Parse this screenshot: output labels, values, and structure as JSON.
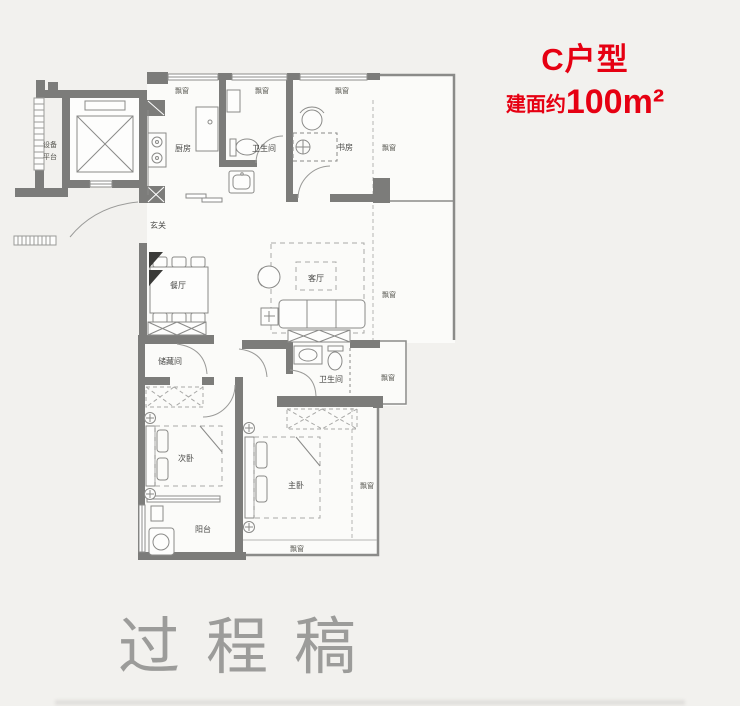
{
  "title": {
    "unit": "C户型",
    "area_prefix": "建面约",
    "area_value": "100m²"
  },
  "watermark": "过程稿",
  "rooms": {
    "equipment_platform_l1": "设备",
    "equipment_platform_l2": "平台",
    "kitchen": "厨房",
    "bathroom_upper": "卫生间",
    "study": "书房",
    "foyer": "玄关",
    "dining": "餐厅",
    "living": "客厅",
    "storage": "储藏间",
    "bathroom_lower": "卫生间",
    "bedroom_second": "次卧",
    "bedroom_master": "主卧",
    "balcony": "阳台",
    "bay_window": "飘窗"
  },
  "colors": {
    "accent_red": "#e60012",
    "wall_gray": "#7c7c7a",
    "label_gray": "#4a4a48",
    "watermark_gray": "#8e8e8c"
  }
}
